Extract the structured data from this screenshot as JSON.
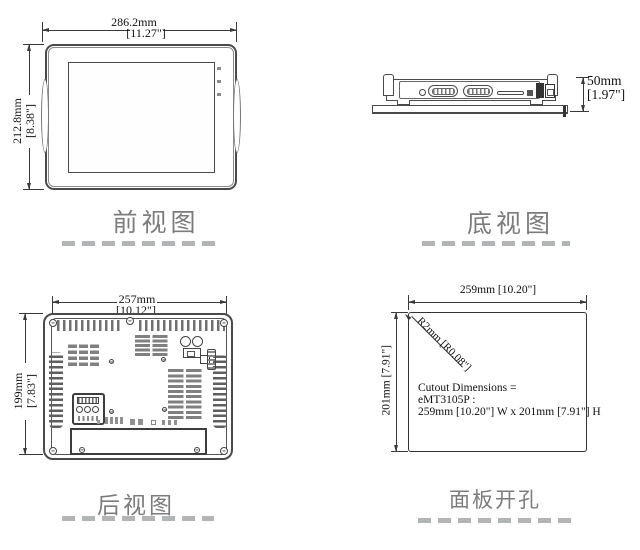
{
  "figure": {
    "front": {
      "caption": "前视图",
      "width_mm": "286.2mm",
      "width_in": "[11.27\"]",
      "height_mm": "212.8mm",
      "height_in": "[8.38\"]"
    },
    "bottom": {
      "caption": "底视图",
      "depth_mm": "50mm",
      "depth_in": "[1.97\"]"
    },
    "rear": {
      "caption": "后视图",
      "width_mm": "257mm",
      "width_in": "[10.12\"]",
      "height_mm": "199mm",
      "height_in": "[7.83\"]"
    },
    "cutout": {
      "caption": "面板开孔",
      "width_label": "259mm [10.20\"]",
      "height_label": "201mm [7.91\"]",
      "radius_label": "R2mm [R0.08\"]",
      "note_line1": "Cutout Dimensions =",
      "note_line2": "eMT3105P :",
      "note_line3": "259mm [10.20\"] W x 201mm [7.91\"] H"
    }
  },
  "colors": {
    "line": "#3a3a3a",
    "caption_gray": "#7c7c7c",
    "dash_gray": "#b2b5b5"
  }
}
